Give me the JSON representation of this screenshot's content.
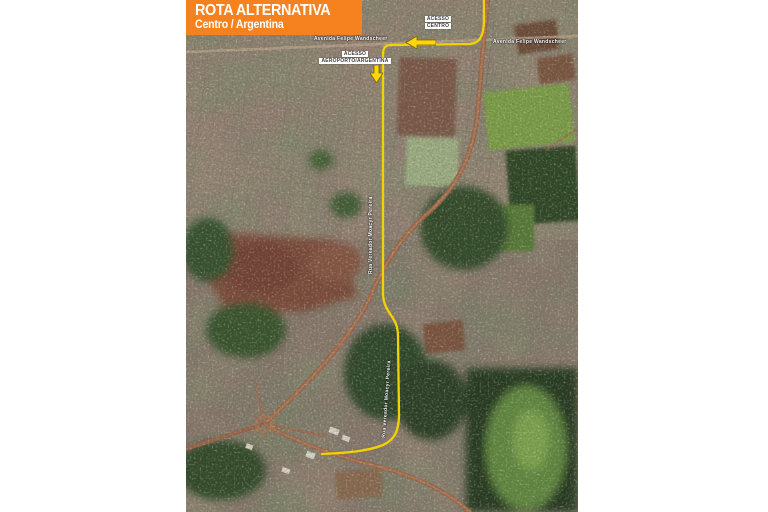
{
  "banner": {
    "title": "ROTA ALTERNATIVA",
    "subtitle": "Centro / Argentina",
    "background_color": "#F6821F",
    "text_color": "#FFFFFF"
  },
  "map": {
    "route_color": "#F2D200",
    "labels": {
      "acesso_centro": {
        "line1": "ACESSO",
        "line2": "CENTRO"
      },
      "acesso_aeroporto": {
        "line1": "ACESSO",
        "line2": "AEROPORTO/ARGENTINA"
      },
      "street_top_left": "Avenida Felipe Wandscheer",
      "street_top_right": "Avenida Felipe Wandscheer",
      "street_mid_vertical": "Rua Vereador Moacyr Pereira",
      "street_bottom_vertical": "Rua Vereador Moacyr Pereira"
    },
    "icons": {
      "arrow_left_color": "#FFD60A",
      "arrow_down_color": "#FFD60A"
    }
  }
}
